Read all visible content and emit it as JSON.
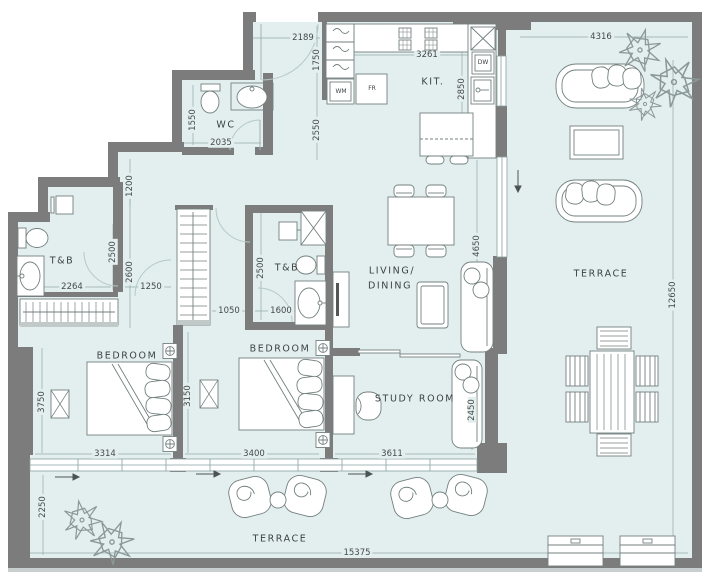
{
  "plan": {
    "rooms": {
      "wc": "WC",
      "tb_left": "T&B",
      "tb_mid": "T&B",
      "kitchen": "KIT.",
      "living_line1": "LIVING/",
      "living_line2": "DINING",
      "bedroom_left": "BEDROOM",
      "bedroom_mid": "BEDROOM",
      "study": "STUDY ROOM",
      "terrace_right": "TERRACE",
      "terrace_bottom": "TERRACE"
    },
    "appliances": {
      "wm": "WM",
      "fr": "FR",
      "dw": "DW"
    },
    "dims": [
      "2189",
      "1750",
      "3261",
      "4316",
      "2850",
      "1550",
      "2035",
      "2550",
      "1200",
      "2500",
      "2600",
      "2264",
      "1250",
      "2500",
      "1050",
      "1600",
      "4650",
      "12650",
      "3750",
      "3150",
      "2450",
      "3314",
      "3400",
      "3611",
      "2250",
      "15375"
    ],
    "colors": {
      "floor": "#e2efee",
      "wall": "#7c7c7c",
      "furniture_outline": "#73807f",
      "glass": "#8aa0a0",
      "dim_line": "#93aaa9",
      "text": "#3c4243"
    }
  }
}
